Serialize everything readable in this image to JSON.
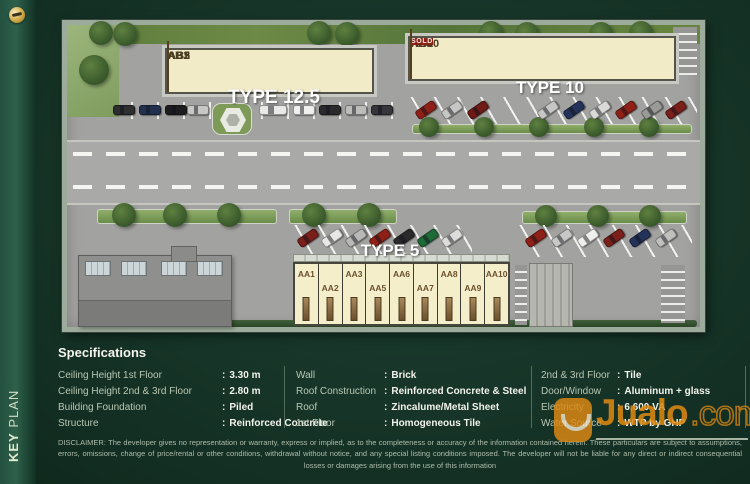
{
  "colors": {
    "background_green": "#143024",
    "building_cream": "#f2ebc8",
    "sold_red": "#8c2013",
    "watermark_orange": "#e08a12",
    "text_light": "#f2f2ec"
  },
  "sidebar": {
    "key_label": "KEY",
    "plan_label": "PLAN"
  },
  "plan": {
    "labels": {
      "type125": "TYPE 12.5",
      "type10": "TYPE 10",
      "type5": "TYPE 5"
    },
    "left_row": {
      "units": [
        "AB1",
        "AB2",
        "AB3",
        "AB5"
      ]
    },
    "right_row": {
      "units": [
        "AB6",
        "AB7",
        "AB8",
        "AB9",
        "AB10"
      ],
      "sold": "SOLD"
    },
    "aa_row": {
      "units": [
        "AA1",
        "AA2",
        "AA3",
        "AA5",
        "AA6",
        "AA7",
        "AA8",
        "AA9",
        "AA10"
      ]
    }
  },
  "specs": {
    "heading": "Specifications",
    "sep": ":",
    "col1": [
      {
        "label": "Ceiling Height 1st Floor",
        "value": "3.30 m"
      },
      {
        "label": "Ceiling Height 2nd & 3rd Floor",
        "value": "2.80 m"
      },
      {
        "label": "Building Foundation",
        "value": "Piled"
      },
      {
        "label": "Structure",
        "value": "Reinforced Concrete"
      }
    ],
    "col2": [
      {
        "label": "Wall",
        "value": "Brick"
      },
      {
        "label": "Roof Construction",
        "value": "Reinforced Concrete & Steel"
      },
      {
        "label": "Roof",
        "value": "Zincalume/Metal Sheet"
      },
      {
        "label": "1st Floor",
        "value": "Homogeneous Tile"
      }
    ],
    "col3": [
      {
        "label": "2nd & 3rd Floor",
        "value": "Tile"
      },
      {
        "label": "Door/Window",
        "value": "Aluminum + glass"
      },
      {
        "label": "Electricity",
        "value": "6,600 VA"
      },
      {
        "label": "Water Source",
        "value": "WTP by GHP"
      }
    ]
  },
  "footer": {
    "disclaimer": "DISCLAIMER: The developer gives no representation or warranty, express or implied, as to the completeness or accuracy of the information contained herein. These particulars are subject to assumptions, errors, omissions, change of price/rental or other conditions, withdrawal without notice, and any special listing conditions imposed. The developer will not be liable for any direct or indirect consequential losses or damages arising from the use of this information"
  },
  "watermark": {
    "name": "Jualo",
    "tld": ".com"
  }
}
